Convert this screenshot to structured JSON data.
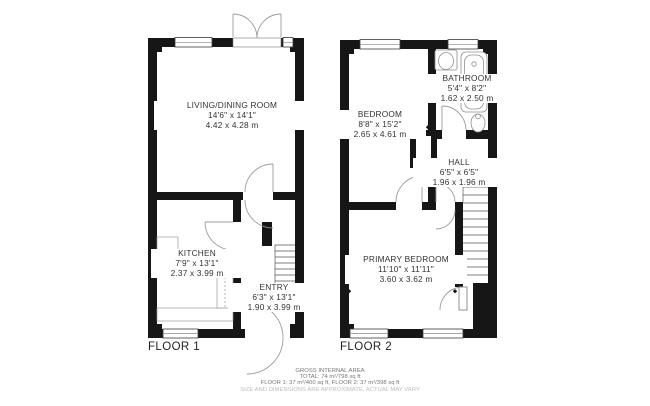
{
  "floor1": {
    "label": "FLOOR 1",
    "rooms": {
      "living": {
        "name": "LIVING/DINING ROOM",
        "imperial": "14'6\" x 14'1\"",
        "metric": "4.42 x 4.28 m"
      },
      "kitchen": {
        "name": "KITCHEN",
        "imperial": "7'9\" x 13'1\"",
        "metric": "2.37 x 3.99 m"
      },
      "entry": {
        "name": "ENTRY",
        "imperial": "6'3\" x 13'1\"",
        "metric": "1.90 x 3.99 m"
      }
    }
  },
  "floor2": {
    "label": "FLOOR 2",
    "rooms": {
      "bedroom": {
        "name": "BEDROOM",
        "imperial": "8'8\" x 15'2\"",
        "metric": "2.65 x 4.61 m"
      },
      "bathroom": {
        "name": "BATHROOM",
        "imperial": "5'4\" x 8'2\"",
        "metric": "1.62 x 2.50 m"
      },
      "hall": {
        "name": "HALL",
        "imperial": "6'5\" x 6'5\"",
        "metric": "1.96 x 1.96 m"
      },
      "primary": {
        "name": "PRIMARY BEDROOM",
        "imperial": "11'10\" x 11'11\"",
        "metric": "3.60 x 3.62 m"
      }
    }
  },
  "footer": {
    "line1": "GROSS INTERNAL AREA",
    "line2": "TOTAL: 74 m²/798 sq ft",
    "line3": "FLOOR 1: 37 m²/400 sq ft, FLOOR 2: 37 m²/398 sq ft",
    "line4": "SIZE AND DIMENSIONS ARE APPROXIMATE, ACTUAL MAY VARY"
  },
  "colors": {
    "wall": "#161616",
    "door_line": "#9b9b9b",
    "fixture_line": "#909090",
    "text": "#333333",
    "muted_text": "#bdbdbd"
  }
}
